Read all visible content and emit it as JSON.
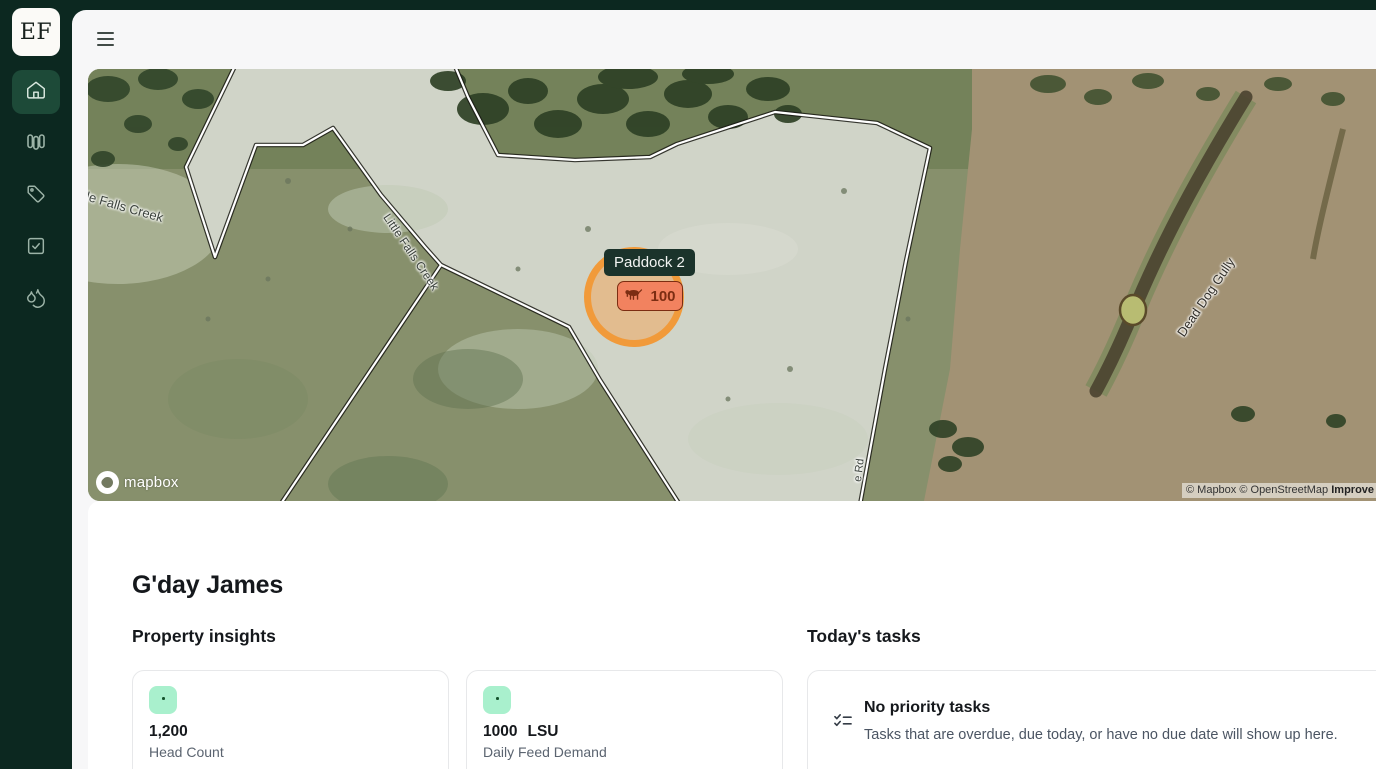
{
  "app": {
    "logo_text": "EF"
  },
  "sidebar": {
    "items": [
      {
        "icon": "home-icon",
        "active": true
      },
      {
        "icon": "paddocks-icon",
        "active": false
      },
      {
        "icon": "tag-icon",
        "active": false
      },
      {
        "icon": "check-square-icon",
        "active": false
      },
      {
        "icon": "droplets-icon",
        "active": false
      }
    ]
  },
  "map": {
    "tooltip": {
      "paddock_name": "Paddock 2",
      "livestock_count": "100"
    },
    "labels": {
      "creek_left": "Little Falls Creek",
      "creek_mid": "Little Falls Creek",
      "gully": "Dead Dog Gully",
      "road": "e Rd"
    },
    "logo": "mapbox",
    "attribution": {
      "copyright": "© Mapbox © OpenStreetMap ",
      "link": "Improve this map"
    }
  },
  "main": {
    "greeting": "G'day James",
    "insights": {
      "title": "Property insights",
      "cards": [
        {
          "value": "1,200",
          "unit": "",
          "label": "Head Count"
        },
        {
          "value": "1000",
          "unit": "LSU",
          "label": "Daily Feed Demand"
        }
      ]
    },
    "tasks": {
      "title": "Today's tasks",
      "empty_title": "No priority tasks",
      "empty_description": "Tasks that are overdue, due today, or have no due date will show up here."
    }
  },
  "colors": {
    "sidebar_bg": "#0c2820",
    "sidebar_active": "#1d4a38",
    "selection_orange": "#f19a3a",
    "badge_bg": "#f2825f",
    "badge_text": "#7c2d12",
    "tooltip_bg": "#1b332b",
    "insight_icon_bg": "#a9f0cd"
  }
}
